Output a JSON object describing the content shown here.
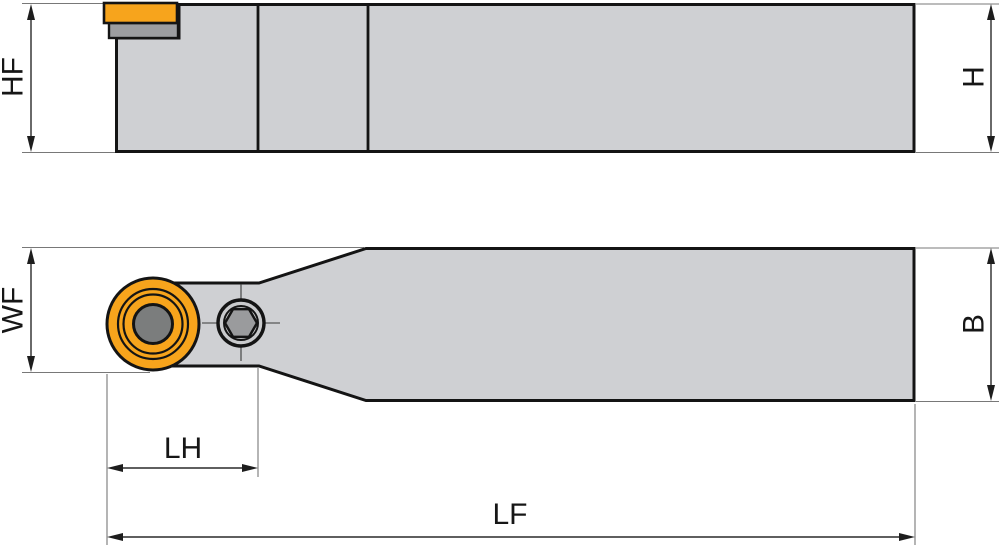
{
  "page": {
    "background": "#ffffff"
  },
  "colors": {
    "body": "#cfd0d3",
    "insert_orange": "#f7a41c",
    "shim_gray": "#9c9da0",
    "hole_gray": "#7b7d7d",
    "hex_gray": "#9a9b9d",
    "screw_face": "#c9cacc",
    "outline": "#141414",
    "dim_line": "#2a2a2a",
    "ext_line": "#787878",
    "label_color": "#161616"
  },
  "side_view": {
    "dims": {
      "hf": "HF",
      "h": "H"
    }
  },
  "plan_view": {
    "dims": {
      "wf": "WF",
      "b": "B",
      "lh": "LH",
      "lf": "LF"
    }
  }
}
